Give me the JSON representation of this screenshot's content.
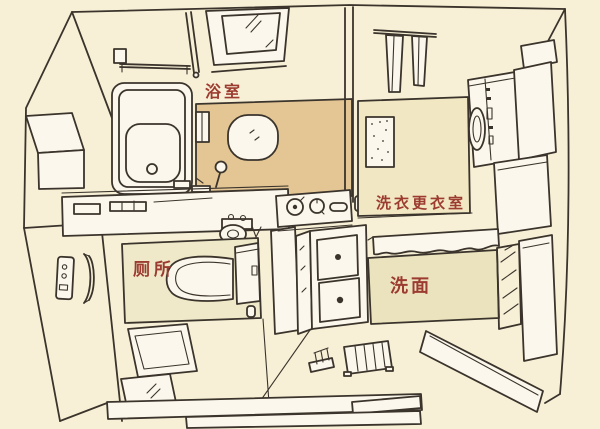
{
  "figure": {
    "type": "hand-drawn isometric floor plan sketch of a Japanese bath / sanitary unit",
    "language": "Chinese"
  },
  "colors": {
    "paper": "#f8f0d6",
    "line": "#3a342c",
    "label": "#9c3b30",
    "bath_floor": "#e4c694",
    "laundry_floor": "#f1e7c2",
    "toilet_floor": "#efe9c9",
    "washbasin_floor": "#ebe3bd",
    "fixture_white": "#fcf7ec"
  },
  "rooms": {
    "bathroom": {
      "label": "浴室"
    },
    "laundry": {
      "label": "洗衣更衣室"
    },
    "toilet": {
      "label": "厕所"
    },
    "washbasin": {
      "label": "洗面"
    }
  },
  "fixtures": [
    "bathtub",
    "wall-mirror",
    "towel-bar",
    "wash-bowl",
    "shower-ladle",
    "glass-partition",
    "hanging-towels",
    "textured-bath-mat",
    "washing-machine",
    "storage-cabinets",
    "toilet-with-tank",
    "hand-rinse-basin",
    "wall-remote",
    "grab-bar",
    "vanity-counter",
    "vanity-drawers",
    "hand-towel-rail",
    "slippers",
    "duckboard-mat",
    "floor-mats",
    "entrance-step"
  ]
}
